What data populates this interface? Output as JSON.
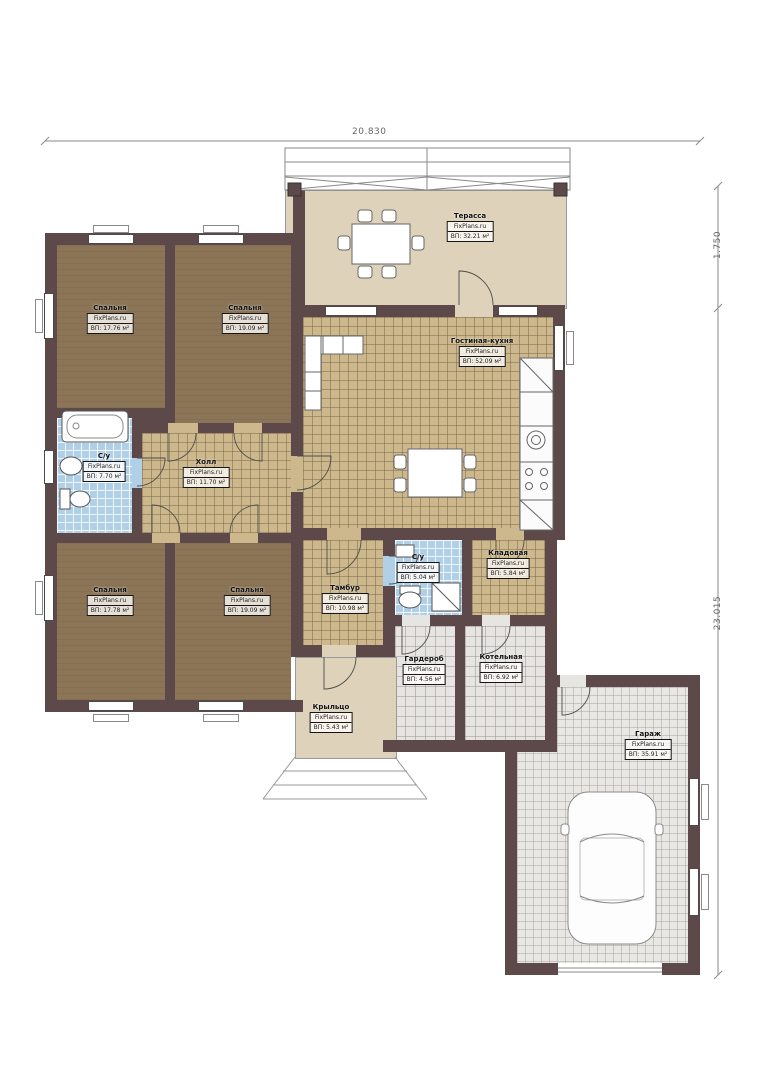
{
  "brand_label": "FixPlans.ru",
  "dimensions": {
    "top_width": "20.830",
    "right_upper": "1.750",
    "right_lower": "23.015"
  },
  "rooms": [
    {
      "name": "Терасса",
      "area": "ВП: 32.21 м²"
    },
    {
      "name": "Спальня",
      "area": "ВП: 17.76 м²"
    },
    {
      "name": "Спальня",
      "area": "ВП: 19.09 м²"
    },
    {
      "name": "С/у",
      "area": "ВП: 7.70 м²"
    },
    {
      "name": "Холл",
      "area": "ВП: 11.70 м²"
    },
    {
      "name": "Гостиная-кухня",
      "area": "ВП: 52.09 м²"
    },
    {
      "name": "Спальня",
      "area": "ВП: 17.78 м²"
    },
    {
      "name": "Спальня",
      "area": "ВП: 19.09 м²"
    },
    {
      "name": "Тамбур",
      "area": "ВП: 10.98 м²"
    },
    {
      "name": "С/у",
      "area": "ВП: 5.04 м²"
    },
    {
      "name": "Кладовая",
      "area": "ВП: 5.84 м²"
    },
    {
      "name": "Гардероб",
      "area": "ВП: 4.56 м²"
    },
    {
      "name": "Котельная",
      "area": "ВП: 6.92 м²"
    },
    {
      "name": "Крыльцо",
      "area": "ВП: 5.43 м²"
    },
    {
      "name": "Гараж",
      "area": "ВП: 35.91 м²"
    }
  ],
  "colors": {
    "wall": "#5d4949",
    "bedroom_floor": "#8c7557",
    "tile_tan": "#cdb88d",
    "tile_blue": "#b0d0e8",
    "tile_gray": "#e7e5e2",
    "terrace_floor": "#ded2ba",
    "dimension_line": "#8a8a8a"
  }
}
